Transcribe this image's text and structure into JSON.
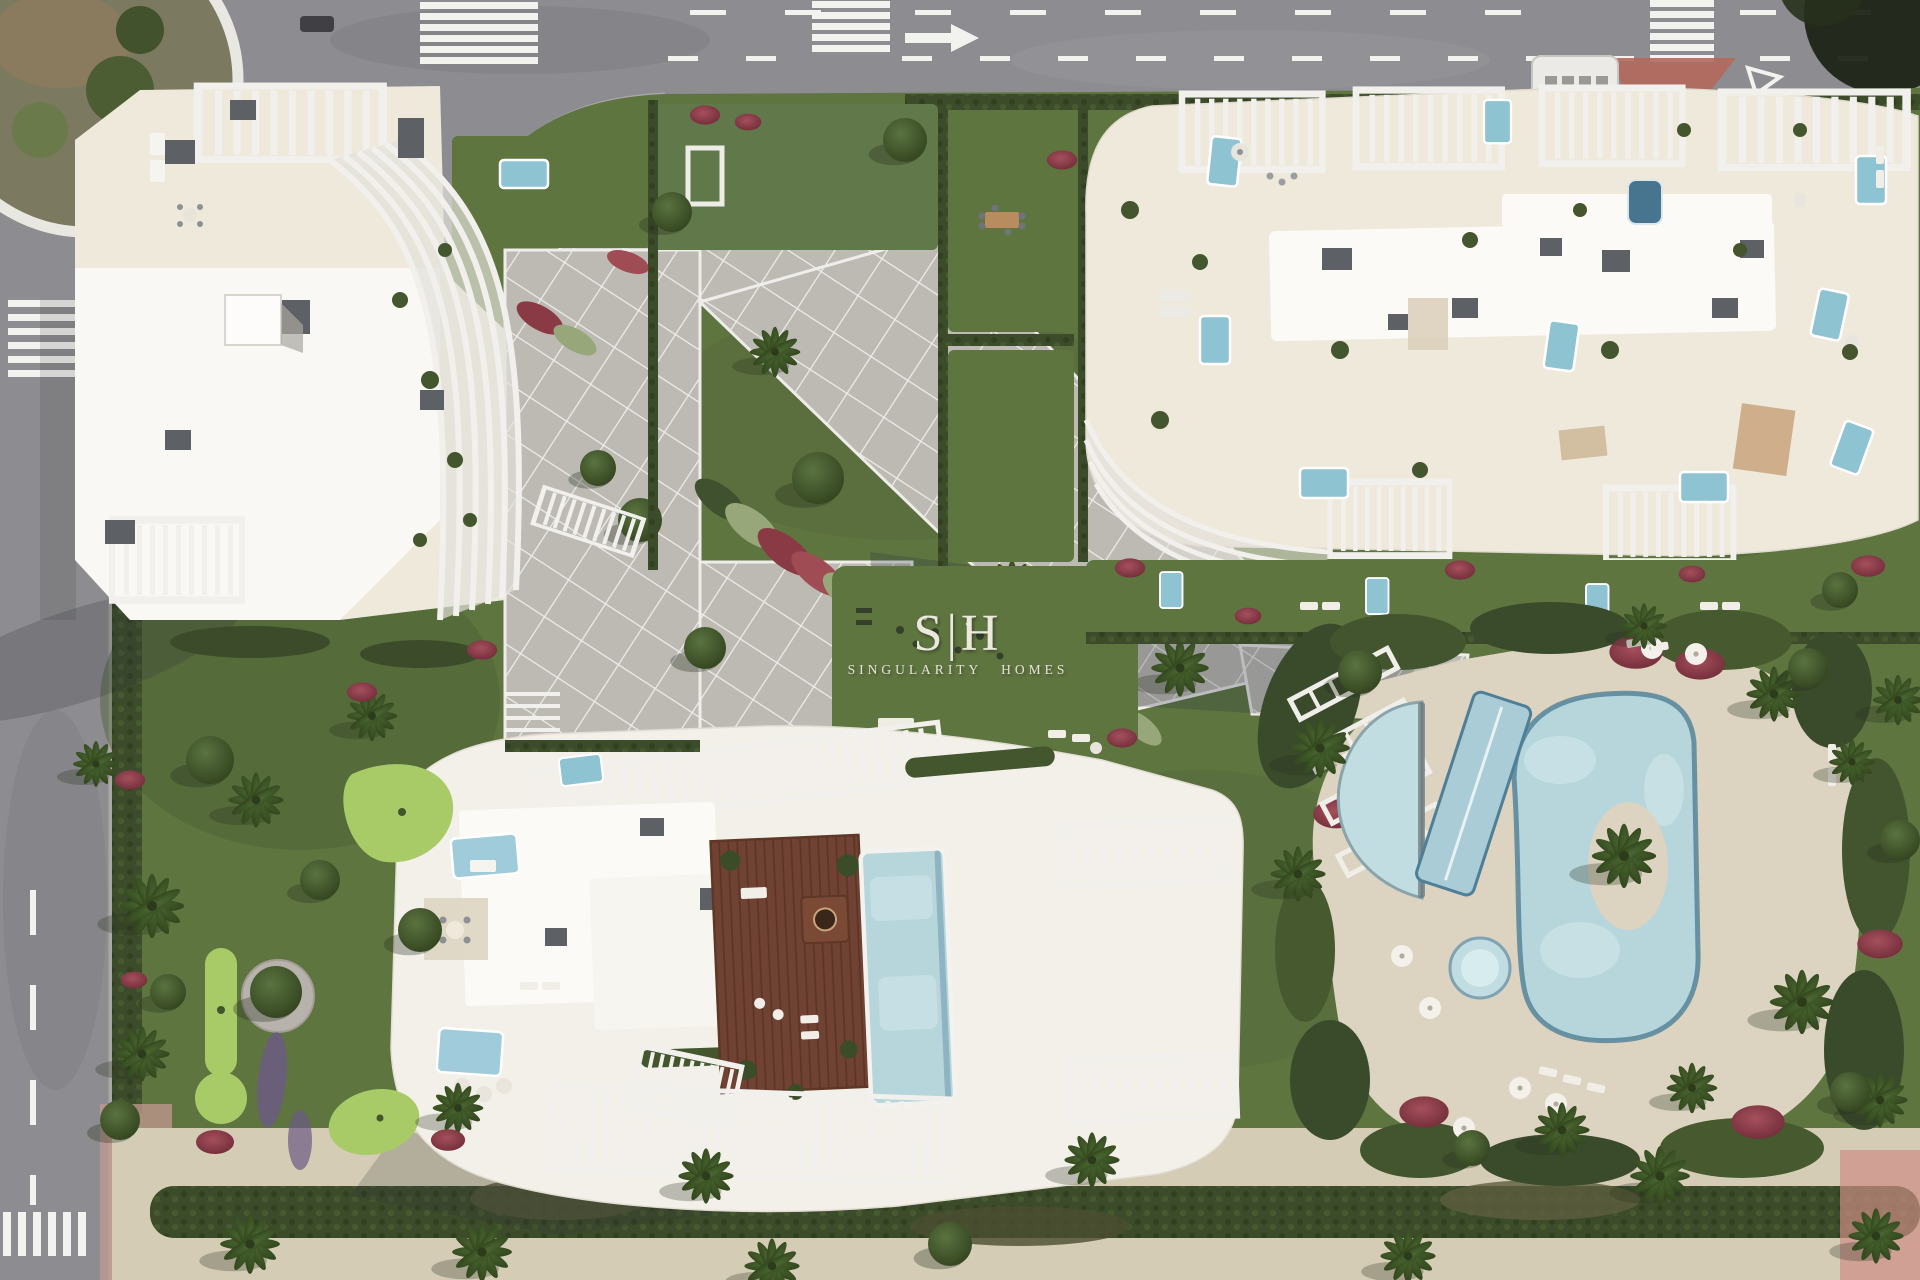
{
  "watermark": {
    "logo": "S|H",
    "name": "SINGULARITY HOMES"
  },
  "colors": {
    "road": "#8d8c90",
    "road_dark": "#7c7b7f",
    "road_marking": "#f2f2ef",
    "grass": "#5e7540",
    "grass_dark": "#4c6034",
    "hedge": "#3c4c2b",
    "paving": "#bdbab4",
    "paving_light": "#c8c5bf",
    "deck_sand": "#dcd3c1",
    "sand_path": "#d5ccb6",
    "building_roof": "#f3f0e9",
    "building_white": "#f9f8f4",
    "roof_slab": "#fbfaf6",
    "terrace_cream": "#efe9dc",
    "rooftop_box": "#5d6065",
    "pool_blue": "#b6d6dc",
    "pool_shallow": "#c2dde2",
    "pool_edge": "#4f7f96",
    "plunge_pool": "#8ec3d2",
    "wood_deck": "#6f4233",
    "flower_red": "#8a3a44",
    "minigolf_green": "#a9cb67",
    "terracotta": "#b4685c",
    "roundabout_ring": "#e9e7e2",
    "shadow": "#2e3438",
    "watermark_fill": "#f3efe6"
  }
}
